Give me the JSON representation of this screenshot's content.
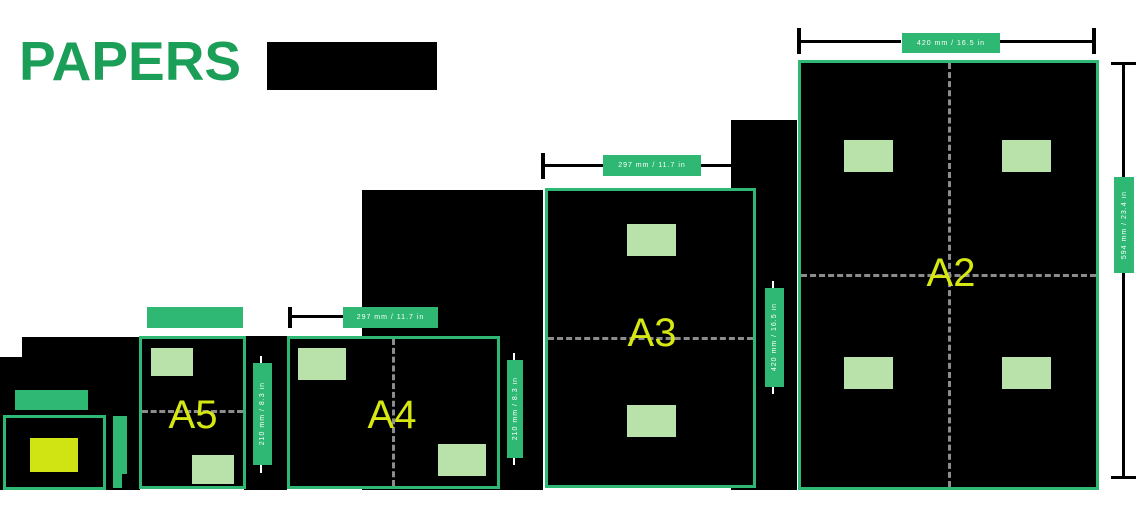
{
  "title": {
    "text": "PAPERS"
  },
  "diagram": {
    "type": "paper-size-comparison",
    "papers": [
      {
        "id": "A2",
        "label": "A2",
        "top_badge_text": "420 mm / 16.5 in",
        "side_badge_text": "594 mm / 23.4 in"
      },
      {
        "id": "A3",
        "label": "A3",
        "top_badge_text": "297 mm / 11.7 in",
        "side_badge_text": "420 mm / 16.5 in"
      },
      {
        "id": "A4",
        "label": "A4",
        "top_badge_text": "297 mm / 11.7 in",
        "side_badge_text": "210 mm / 8.3 in"
      },
      {
        "id": "A5",
        "label": "A5",
        "top_badge_text": "",
        "side_badge_text": "210 mm / 8.3 in"
      },
      {
        "id": "A6",
        "label": "",
        "top_badge_text": "",
        "side_badge_text": ""
      }
    ]
  },
  "colors": {
    "badge_green": "#2eb873",
    "title_green": "#1b9e57",
    "light_green": "#b9e2ab",
    "label_yellow": "#d6e712",
    "small_sheet_yellow": "#cfe412",
    "sheet_black": "#000000",
    "fold_dash_gray": "#8c8c8c",
    "badge_text_white": "#ffffff"
  }
}
